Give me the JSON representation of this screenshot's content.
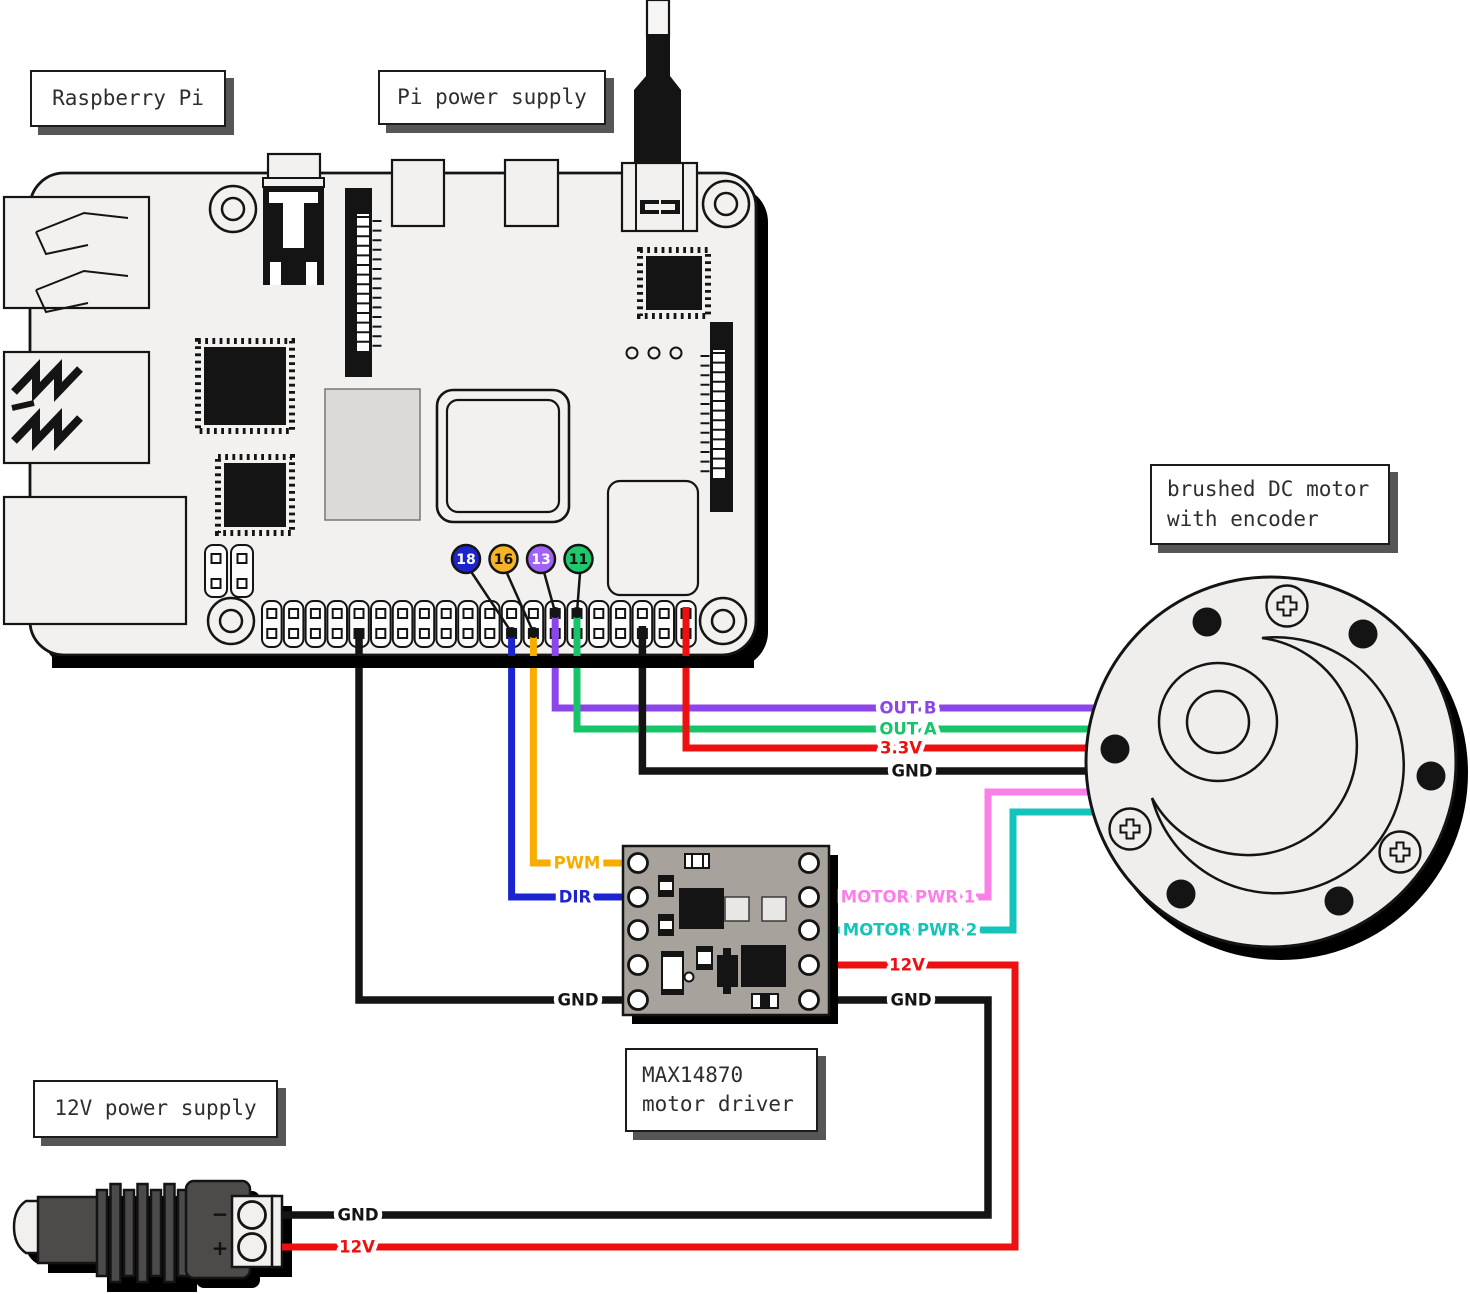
{
  "captions": {
    "raspberry_pi": "Raspberry Pi",
    "pi_power_supply": "Pi power supply",
    "motor_line1": "brushed DC motor",
    "motor_line2": "with encoder",
    "driver_line1": "MAX14870",
    "driver_line2": "motor driver",
    "supply_12v": "12V power supply"
  },
  "pins": [
    {
      "label": "18",
      "color": "#1B24CF",
      "text": "#ffffff"
    },
    {
      "label": "16",
      "color": "#F5B325",
      "text": "#141414"
    },
    {
      "label": "13",
      "color": "#A163F7",
      "text": "#ffffff"
    },
    {
      "label": "11",
      "color": "#1EC96B",
      "text": "#141414"
    }
  ],
  "wire_labels": {
    "out_b": "OUT B",
    "out_a": "OUT A",
    "v3_3": "3.3V",
    "gnd_to_motor": "GND",
    "pwm": "PWM",
    "dir": "DIR",
    "gnd_pi_to_driver": "GND",
    "motor_pwr_1": "MOTOR PWR 1",
    "motor_pwr_2": "MOTOR PWR 2",
    "v12_at_driver": "12V",
    "gnd_at_driver": "GND",
    "gnd_at_supply": "GND",
    "v12_at_supply": "12V"
  },
  "power_jack": {
    "minus": "−",
    "plus": "+"
  },
  "colors": {
    "blue": "#1B24CF",
    "orange": "#F8AC00",
    "purple": "#8C45E8",
    "green": "#17C46A",
    "red": "#EE1010",
    "pink": "#FA80E8",
    "cyan": "#14C4BA",
    "black": "#141414"
  }
}
